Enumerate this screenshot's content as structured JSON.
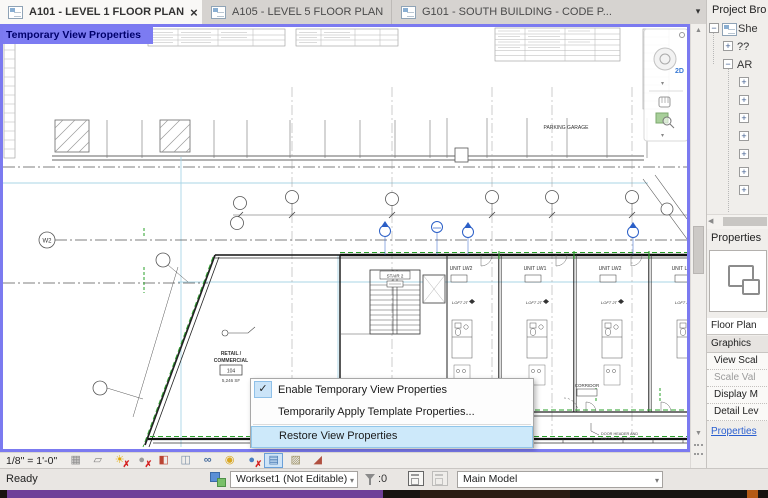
{
  "colors": {
    "temporary_view_accent": "#7b7af0",
    "menu_highlight": "#cde9fa",
    "selection_green": "#2aa02a",
    "section_marker_blue": "#2b5fc7",
    "link_blue": "#2a5fd0",
    "taskbar_purple": "#6e3f98"
  },
  "tab_bar": {
    "tabs": [
      {
        "label": "A101 - LEVEL 1 FLOOR PLAN",
        "active": true,
        "close_glyph": "×"
      },
      {
        "label": "A105 - LEVEL 5 FLOOR PLAN",
        "active": false
      },
      {
        "label": "G101 - SOUTH BUILDING - CODE P...",
        "active": false
      }
    ],
    "list_chevron_glyph": "▾"
  },
  "canvas": {
    "banner": "Temporary View Properties",
    "plan": {
      "parking_label": "PARKING GARAGE",
      "grid_bubble_w2": "W2",
      "stair_label": "STAIR 2",
      "unit_labels": [
        "UNIT LW2",
        "UNIT LW1",
        "UNIT LW2",
        "UNIT LW1"
      ],
      "loft_tag": "LOFT 2T",
      "retail_line1": "RETAIL /",
      "retail_line2": "COMMERCIAL",
      "retail_room_number": "104",
      "retail_area": "5,246 SF",
      "corridor_label": "CORRIDOR",
      "note_line1": "DOOR HEADER AND",
      "note_line2": "KNOCK-OUT WALL"
    },
    "nav_bar": {
      "wheel_badge": "2D"
    }
  },
  "context_menu": {
    "check_glyph": "✓",
    "items": [
      {
        "label": "Enable Temporary View Properties",
        "checked": true
      },
      {
        "label": "Temporarily Apply Template Properties...",
        "checked": false
      },
      {
        "label": "Restore View Properties",
        "highlighted": true
      }
    ]
  },
  "view_control_bar": {
    "scale": "1/8\" = 1'-0\"",
    "icons": [
      {
        "name": "detail-level-icon",
        "glyph": "▦"
      },
      {
        "name": "visual-style-icon",
        "glyph": "▱"
      },
      {
        "name": "sun-path-icon",
        "glyph": "☀",
        "off": true
      },
      {
        "name": "shadows-icon",
        "glyph": "●",
        "off": true
      },
      {
        "name": "crop-view-icon",
        "glyph": "◧"
      },
      {
        "name": "crop-region-icon",
        "glyph": "◫"
      },
      {
        "name": "temporary-hide-isolate-icon",
        "glyph": "∞"
      },
      {
        "name": "reveal-hidden-elements-icon",
        "glyph": "◉"
      },
      {
        "name": "worksharing-display-icon",
        "glyph": "●",
        "off": true
      },
      {
        "name": "temporary-view-properties-icon",
        "glyph": "▤",
        "active": true
      },
      {
        "name": "analytical-model-icon",
        "glyph": "▨"
      },
      {
        "name": "reveal-constraints-icon",
        "glyph": "◢"
      }
    ]
  },
  "status_bar": {
    "ready": "Ready",
    "workset_value": "Workset1 (Not Editable)",
    "selection_count": ":0",
    "design_option_value": "Main Model",
    "chevron_glyph": "▾"
  },
  "project_browser": {
    "title": "Project Bro",
    "root_label": "She",
    "child1_label": "??",
    "child2_label": "AR",
    "minus_glyph": "−",
    "plus_glyph": "+"
  },
  "properties_panel": {
    "title": "Properties",
    "type_row": "Floor Plan",
    "section_graphics": "Graphics",
    "rows": [
      {
        "label": "View Scal"
      },
      {
        "label": "Scale Val",
        "muted": true
      },
      {
        "label": "Display M"
      },
      {
        "label": "Detail Lev"
      }
    ],
    "link": "Properties"
  },
  "ui_glyphs": {
    "up": "▲",
    "down": "▼",
    "left": "◀",
    "chevron_down": "▾"
  }
}
